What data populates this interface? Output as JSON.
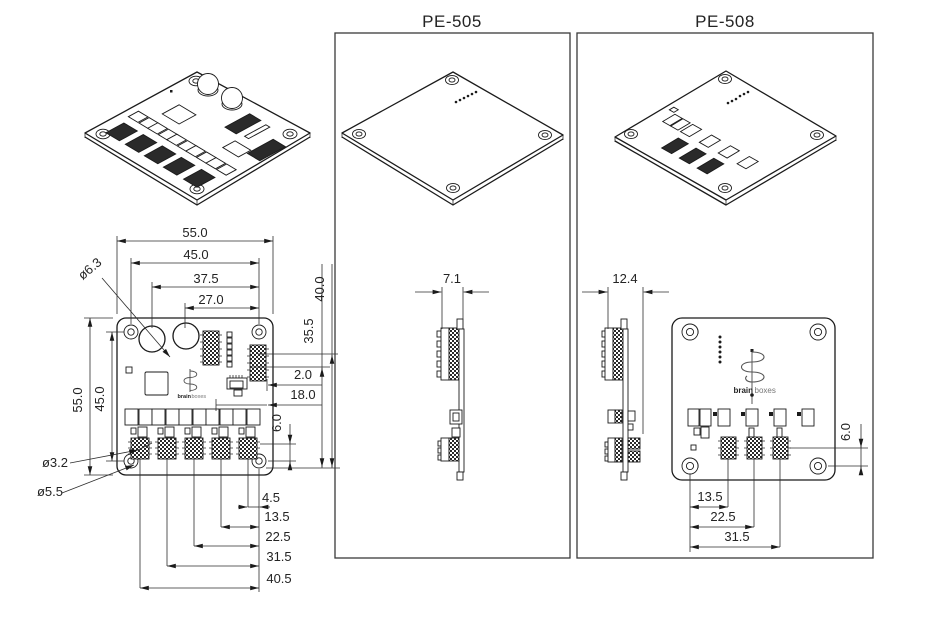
{
  "pe505": {
    "title": "PE-505",
    "dims": {
      "side_width": "7.1"
    }
  },
  "pe508": {
    "title": "PE-508",
    "dims": {
      "side_width": "12.4",
      "connector_offset": "6.0",
      "chain": [
        "13.5",
        "22.5",
        "31.5"
      ]
    }
  },
  "main_view": {
    "dims": {
      "top": [
        "55.0",
        "45.0",
        "37.5",
        "27.0"
      ],
      "left": [
        "55.0",
        "45.0"
      ],
      "right": [
        "40.0",
        "35.5",
        "2.0",
        "18.0",
        "6.0"
      ],
      "chain": [
        "4.5",
        "13.5",
        "22.5",
        "31.5",
        "40.5"
      ],
      "cap_diameter": "ø6.3",
      "hole_diameter": "ø3.2",
      "pad_diameter": "ø5.5"
    }
  },
  "logo": {
    "brain": "brain",
    "boxes": "boxes"
  }
}
